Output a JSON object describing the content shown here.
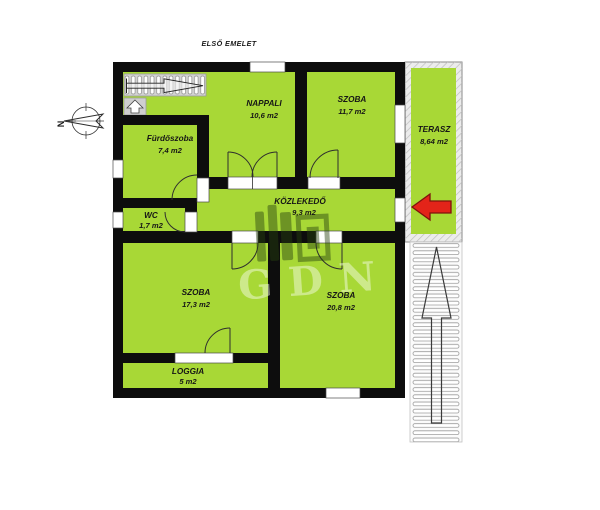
{
  "title": "ELSŐ EMELET",
  "floorplan": {
    "rooms": {
      "nappali": {
        "name": "NAPPALI",
        "area": "10,6 m2"
      },
      "szoba_felso": {
        "name": "SZOBA",
        "area": "11,7 m2"
      },
      "furdoszoba": {
        "name": "Fürdőszoba",
        "area": "7,4 m2"
      },
      "wc": {
        "name": "WC",
        "area": "1,7 m2"
      },
      "kozlekedo": {
        "name": "KÖZLEKEDŐ",
        "area": "9,3 m2"
      },
      "szoba_bal": {
        "name": "SZOBA",
        "area": "17,3 m2"
      },
      "szoba_also": {
        "name": "SZOBA",
        "area": "20,8 m2"
      },
      "loggia": {
        "name": "LOGGIA",
        "area": "5 m2"
      },
      "terasz": {
        "name": "TERASZ",
        "area": "8,64 m2"
      }
    },
    "compass": {
      "north_label": "N"
    },
    "watermark": {
      "text": "GDN"
    },
    "colors": {
      "room_fill": "#a8d836",
      "wall": "#0d0d0d",
      "direction_arrow_red": "#e32419",
      "stairs_gray": "#d2d2d2",
      "opening_white": "#ffffff"
    }
  }
}
